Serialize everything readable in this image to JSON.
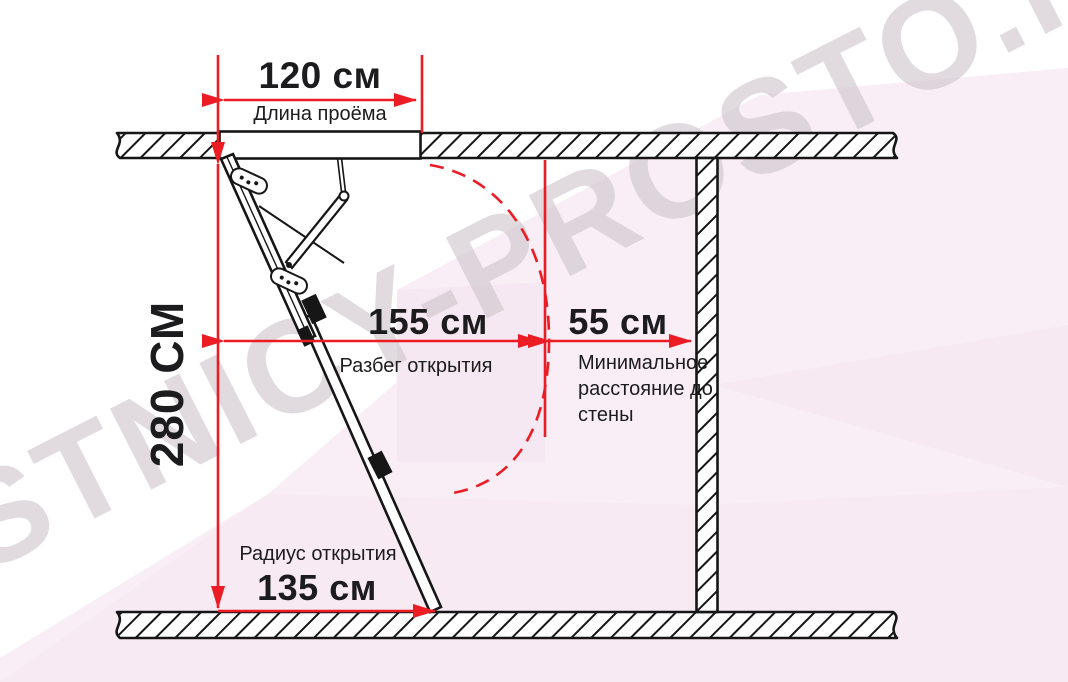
{
  "watermark": "LESTNICY-PROSTO.RU",
  "diagram": {
    "opening_length": {
      "value": "120 см",
      "label": "Длина проёма"
    },
    "ceiling_height": {
      "value": "280 СМ"
    },
    "opening_run": {
      "value": "155 см",
      "label": "Разбег открытия"
    },
    "min_wall_distance": {
      "value": "55 см",
      "label": "Минимальное расстояние до стены"
    },
    "opening_radius": {
      "value": "135 см",
      "label": "Радиус открытия"
    }
  },
  "colors": {
    "accent_red": "#ec1c24",
    "line_black": "#161616",
    "text_black": "#1c1c1e",
    "background_pink": "#f9eef6",
    "background_pink_shade": "#f4e3ee",
    "watermark_gray": "#cfc5cc"
  }
}
